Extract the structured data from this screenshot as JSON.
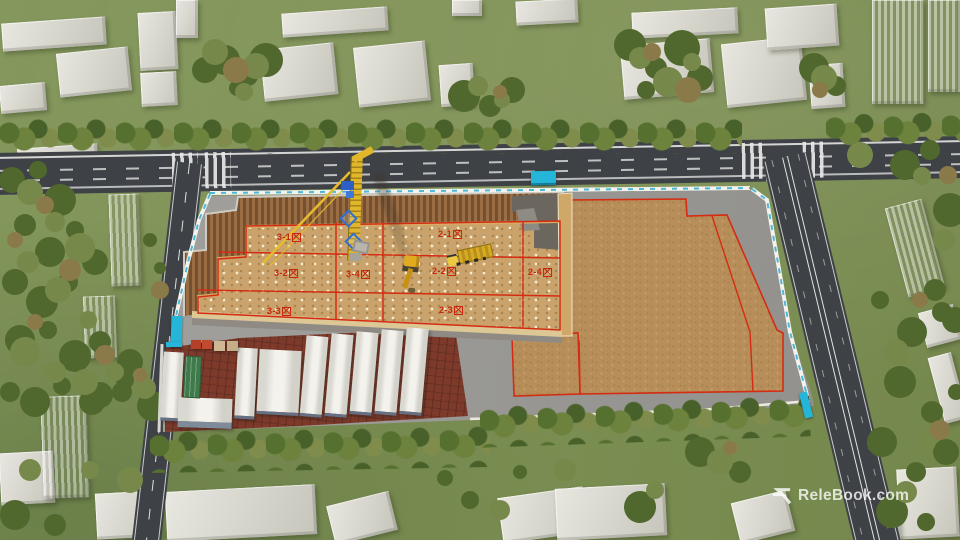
{
  "site": {
    "zones": [
      {
        "id": "3-1",
        "num": "3-1",
        "label": "3-1区"
      },
      {
        "id": "3-2",
        "num": "3-2",
        "label": "3-2区"
      },
      {
        "id": "3-3",
        "num": "3-3",
        "label": "3-3区"
      },
      {
        "id": "3-4",
        "num": "3-4",
        "label": "3-4区"
      },
      {
        "id": "2-1",
        "num": "2-1",
        "label": "2-1区"
      },
      {
        "id": "2-2",
        "num": "2-2",
        "label": "2-2区"
      },
      {
        "id": "2-3",
        "num": "2-3",
        "label": "2-3区"
      },
      {
        "id": "2-4",
        "num": "2-4",
        "label": "2-4区"
      }
    ]
  },
  "watermark": {
    "icon": "relebook-logo-icon",
    "text": "ReleBook.com"
  },
  "colors": {
    "accent_red": "#c8260e",
    "fence_cyan": "#4db7d8",
    "gate_cyan": "#25b5d8",
    "crane_yellow": "#e5bb2c",
    "pit_floor_tan": "#c9a36b",
    "dirt_brown": "#b78e5a",
    "grass_green": "#7e9154",
    "asphalt": "#3e4145",
    "brick_red": "#7d3a2b"
  }
}
